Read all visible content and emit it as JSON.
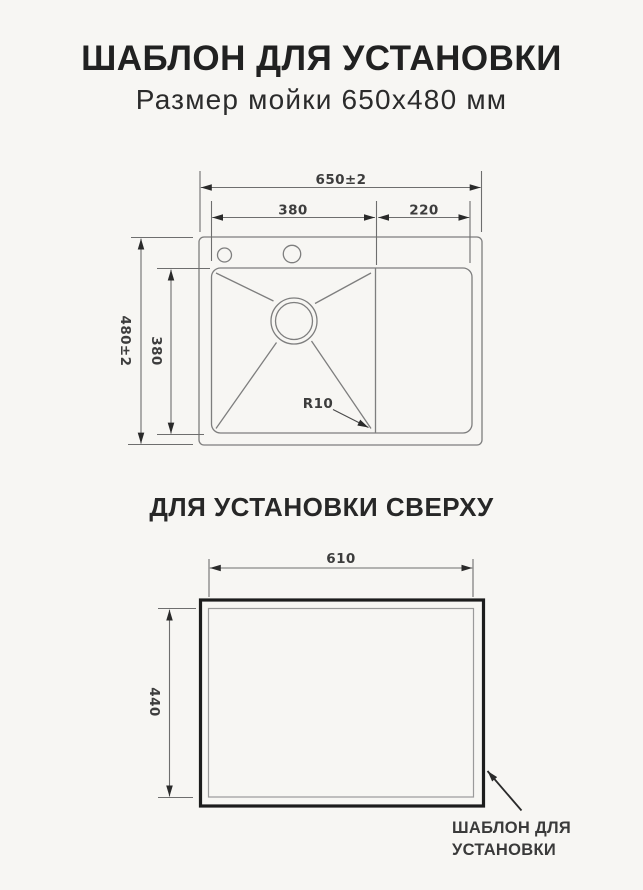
{
  "header": {
    "title": "ШАБЛОН ДЛЯ УСТАНОВКИ",
    "subtitle": "Размер мойки 650x480 мм"
  },
  "section_title": "ДЛЯ УСТАНОВКИ СВЕРХУ",
  "top_view": {
    "label_overall_width": "650±2",
    "label_bowl_width": "380",
    "label_drainer_width": "220",
    "label_overall_depth": "480±2",
    "label_bowl_depth": "380",
    "label_corner_radius": "R10"
  },
  "template_view": {
    "label_cutout_width": "610",
    "label_cutout_height": "440",
    "callout_line1": "ШАБЛОН ДЛЯ",
    "callout_line2": "УСТАНОВКИ"
  },
  "colors": {
    "background": "#f7f6f3",
    "title_ink": "#212121",
    "drawing_line": "#7e7e7e",
    "dimension_line": "#6e6e6e",
    "dimension_text": "#3d3d3d",
    "template_border": "#1c1c1c"
  }
}
